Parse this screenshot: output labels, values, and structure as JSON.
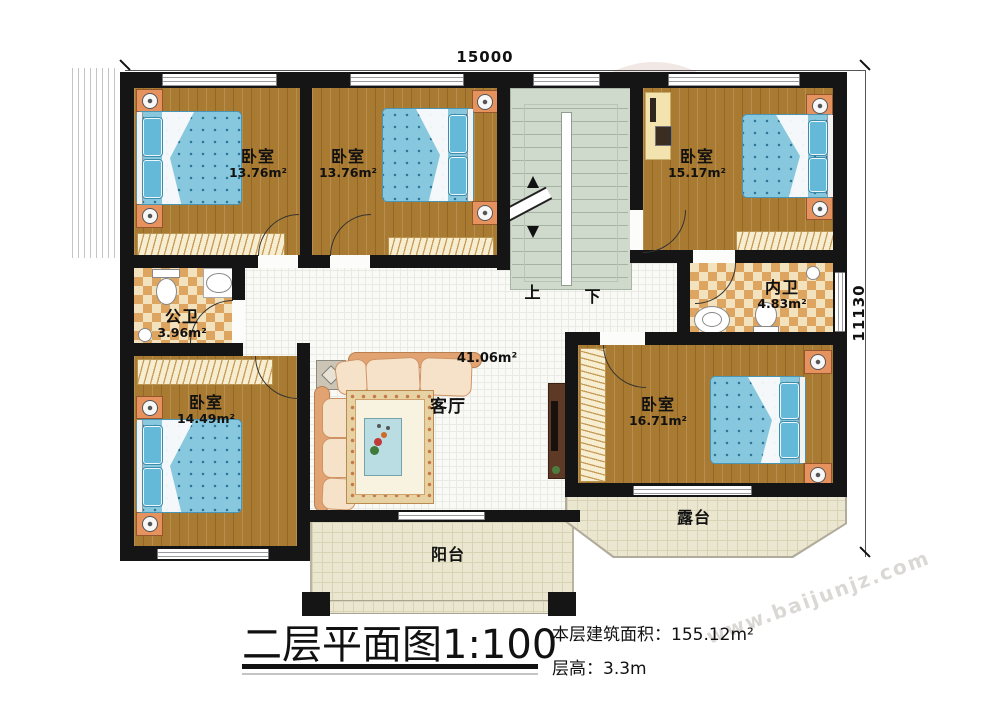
{
  "watermark": {
    "text": "www.baijunjz.com"
  },
  "dimensions": {
    "top": "15000",
    "right": "11130"
  },
  "stairs": {
    "up": "上",
    "down": "下"
  },
  "rooms": {
    "bedroom_tl": {
      "name": "卧室",
      "area": "13.76m²"
    },
    "bedroom_tm": {
      "name": "卧室",
      "area": "13.76m²"
    },
    "bedroom_tr": {
      "name": "卧室",
      "area": "15.17m²"
    },
    "bedroom_bl": {
      "name": "卧室",
      "area": "14.49m²"
    },
    "bedroom_br": {
      "name": "卧室",
      "area": "16.71m²"
    },
    "bath_public": {
      "name": "公卫",
      "area": "3.96m²"
    },
    "bath_private": {
      "name": "内卫",
      "area": "4.83m²"
    },
    "living": {
      "name": "客厅",
      "area": "41.06m²"
    },
    "balcony": {
      "name": "阳台"
    },
    "terrace": {
      "name": "露台"
    }
  },
  "titleblock": {
    "title": "二层平面图1:100",
    "floor_area_label": "本层建筑面积：",
    "floor_area_value": "155.12m²",
    "floor_height_label": "层高：",
    "floor_height_value": "3.3m"
  }
}
